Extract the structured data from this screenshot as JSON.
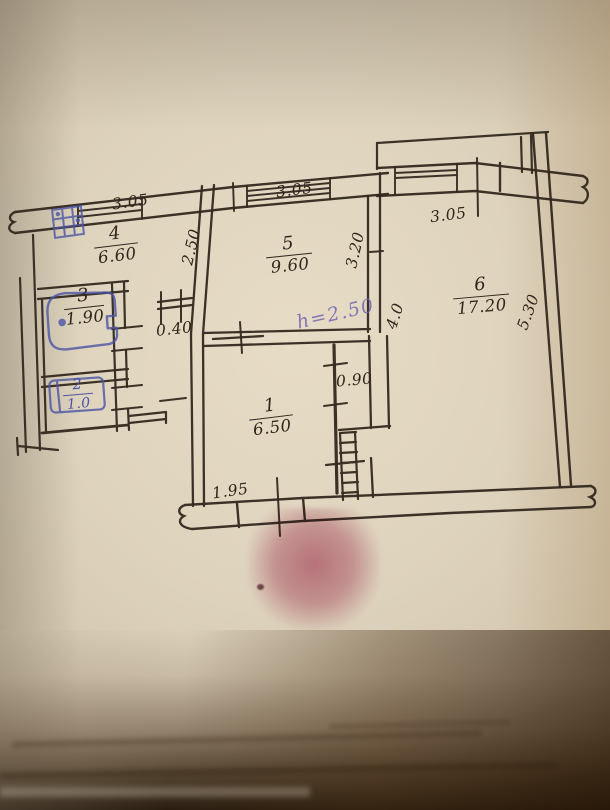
{
  "plan": {
    "rooms": [
      {
        "number": "1",
        "area": "6.50"
      },
      {
        "number": "2",
        "area": "1.0"
      },
      {
        "number": "3",
        "area": "1.90"
      },
      {
        "number": "4",
        "area": "6.60"
      },
      {
        "number": "5",
        "area": "9.60"
      },
      {
        "number": "6",
        "area": "17.20"
      }
    ],
    "dimensions": {
      "kitchen_width": "3.05",
      "room5_width": "3.05",
      "room6_width": "3.05",
      "kitchen_depth": "2.50",
      "room5_depth": "3.20",
      "room6_left_depth": "4.0",
      "room6_right_depth": "5.30",
      "corridor_offset": "0.40",
      "door_width": "0.90",
      "entry_width": "1.95"
    },
    "annotations": {
      "ceiling_height": "h=2.50"
    },
    "symbols": {
      "stove": "stove-icon",
      "bathtub": "bathtub-icon",
      "toilet": "toilet-icon",
      "stairs": "stairs-icon"
    },
    "colors": {
      "ink": "#33291f",
      "blue_ink": "#4b55a6",
      "purple_ink": "#7264b4",
      "paper": "#dcd1bb",
      "stain": "#b85f7d"
    }
  }
}
